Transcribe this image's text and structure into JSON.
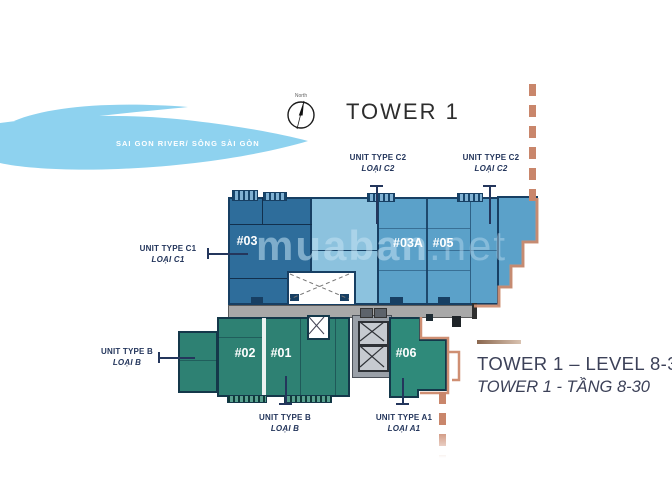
{
  "title": "TOWER 1",
  "compass": {
    "north_label": "North"
  },
  "river": {
    "label": "SAI GON RIVER/ SÔNG SÀI GÒN"
  },
  "watermark": {
    "name": "muaban",
    "suffix": ".net"
  },
  "units": {
    "u03": {
      "number": "#03"
    },
    "u03a": {
      "number": "#03A"
    },
    "u05": {
      "number": "#05"
    },
    "u02": {
      "number": "#02"
    },
    "u01": {
      "number": "#01"
    },
    "u06": {
      "number": "#06"
    }
  },
  "labels": {
    "c1": {
      "line1": "UNIT TYPE C1",
      "line2": "LOẠI C1"
    },
    "c2a": {
      "line1": "UNIT TYPE C2",
      "line2": "LOẠI C2"
    },
    "c2b": {
      "line1": "UNIT TYPE C2",
      "line2": "LOẠI C2"
    },
    "b_left": {
      "line1": "UNIT TYPE B",
      "line2": "LOẠI B"
    },
    "b_bottom": {
      "line1": "UNIT TYPE B",
      "line2": "LOẠI B"
    },
    "a1": {
      "line1": "UNIT TYPE A1",
      "line2": "LOẠI A1"
    }
  },
  "legend": {
    "line1": "TOWER 1 – LEVEL 8-30",
    "line2": "TOWER 1 - TẦNG 8-30"
  },
  "palette": {
    "river": "#8ed2ef",
    "unit_c1_dark_blue": "#2e6d9b",
    "unit_mid_light_blue": "#8cc2de",
    "unit_c2_medium_blue": "#5ba1c9",
    "unit_b_green": "#2e8173",
    "unit_06_green": "#2f8a7a",
    "wall_navy": "#173f63",
    "corridor_gray": "#a8a8a8",
    "balcony_salmon": "#cf8f73",
    "boundary_dash_salmon": "#c9866b",
    "label_navy": "#24365c",
    "legend_text": "#3c4158",
    "legend_rule_bronze": "#8a674e"
  }
}
